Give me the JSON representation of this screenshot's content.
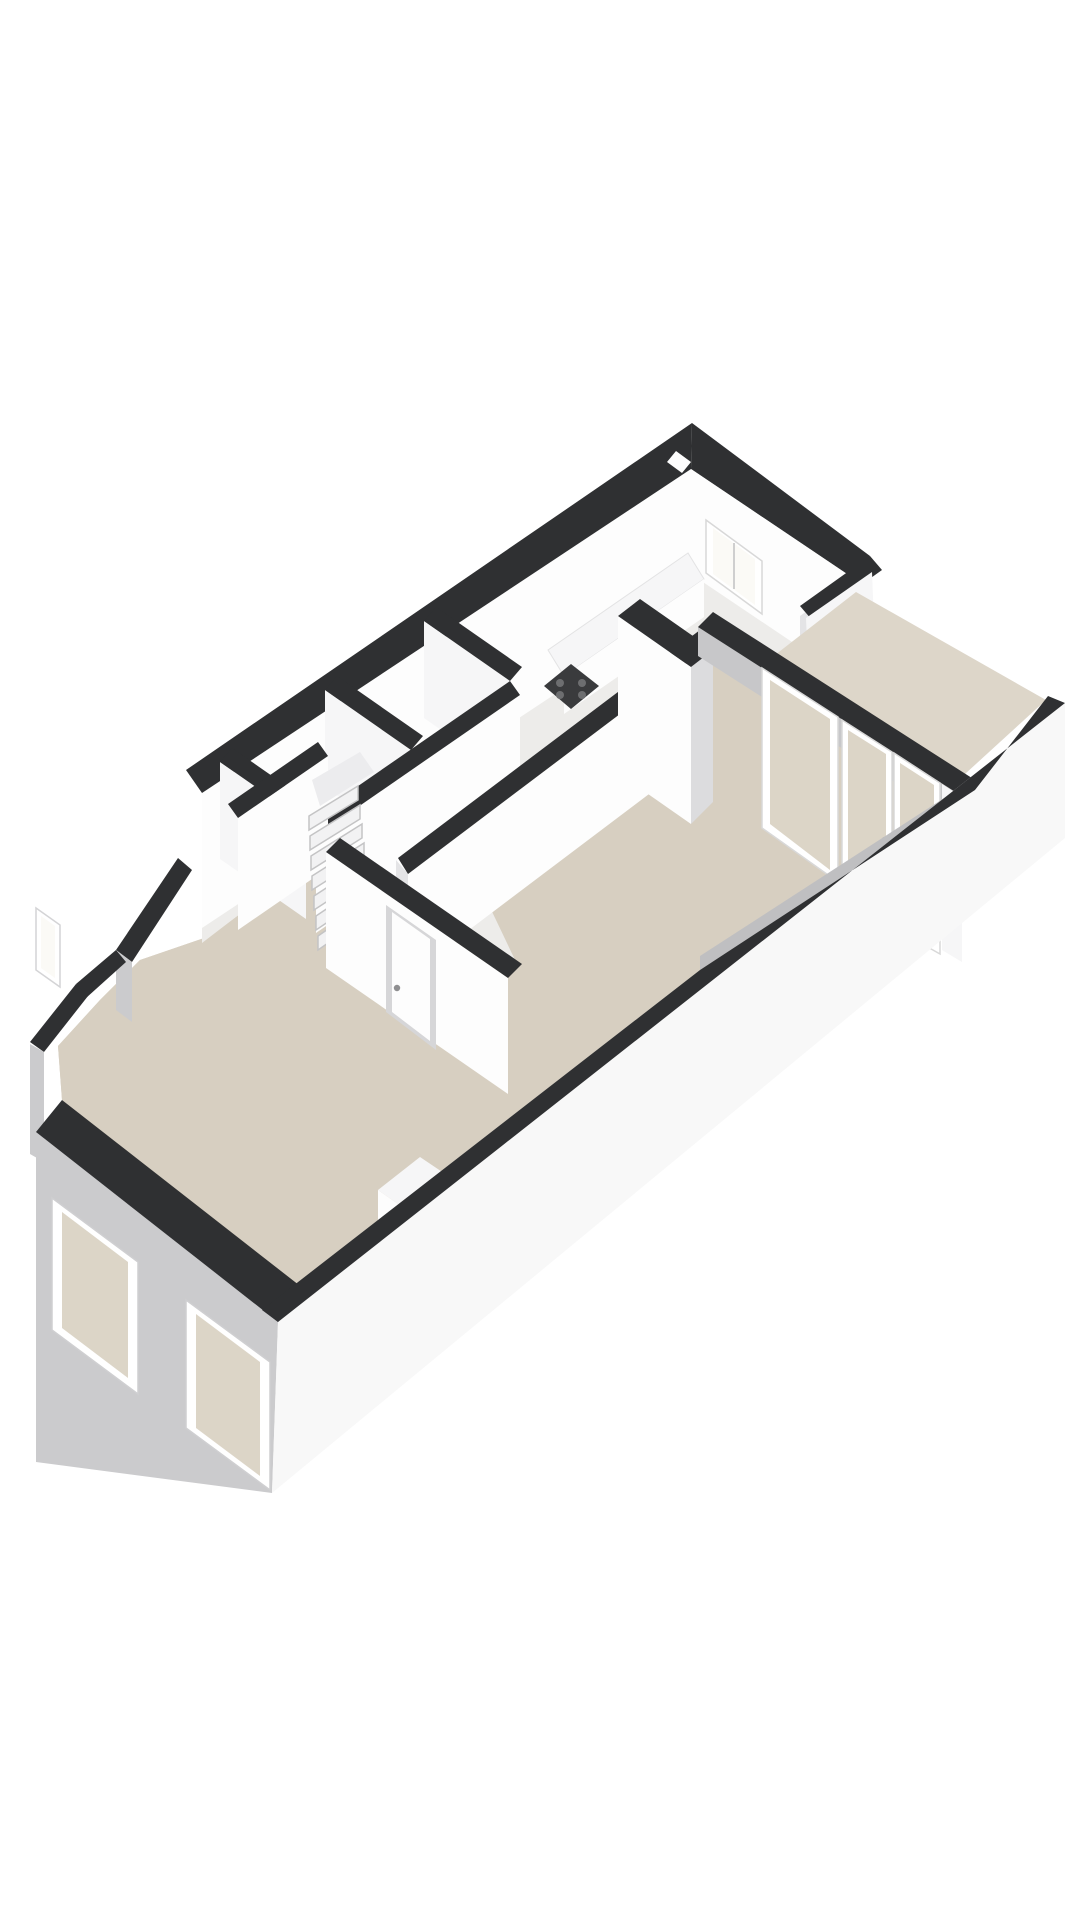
{
  "scene": {
    "type": "isometric-3d-floorplan",
    "background": "#ffffff",
    "palette": {
      "wallTop": "#2f3032",
      "wallWhite": "#fdfdfd",
      "wallFace": "#f6f6f7",
      "wallShade": "#e4e4e6",
      "wallGray": "#d9d9db",
      "extGray": "#cbcbcd",
      "extGrayDark": "#c2c2c4",
      "sidePlane": "#f8f8f8",
      "floorBeige": "#d7cfc1",
      "floorBeigeLight": "#ddd6c9",
      "floorPale": "#edecea",
      "glassBeige": "#dcd5c7",
      "glassWhite": "#fbfaf6",
      "frameWhite": "#ffffff",
      "frameShade": "#d6d6d8",
      "stoveDark": "#3a3b3d",
      "stoveBurner": "#6d6e70",
      "handleGray": "#8f8f91",
      "stepTop": "#f2f2f3",
      "stepEdge": "#c6c6c8",
      "lintelGray": "#c7c7c9",
      "innerStrip": "#bfbfc1",
      "columnSide": "#dcdcde",
      "landing": "#ececee"
    },
    "features": [
      {
        "name": "rear-annex-room",
        "kind": "room"
      },
      {
        "name": "rear-window",
        "kind": "window"
      },
      {
        "name": "kitchen-counter",
        "kind": "fixture"
      },
      {
        "name": "gas-hob",
        "kind": "appliance"
      },
      {
        "name": "chimney-column",
        "kind": "structure"
      },
      {
        "name": "french-doors",
        "kind": "door"
      },
      {
        "name": "garden-window",
        "kind": "window"
      },
      {
        "name": "back-garden-floor",
        "kind": "exterior-floor"
      },
      {
        "name": "right-boundary-wall",
        "kind": "wall"
      },
      {
        "name": "winder-staircase",
        "kind": "stairs"
      },
      {
        "name": "hallway-door",
        "kind": "door"
      },
      {
        "name": "partition-walls",
        "kind": "wall"
      },
      {
        "name": "entrance-diagonal-wall",
        "kind": "wall"
      },
      {
        "name": "front-window-left",
        "kind": "window"
      },
      {
        "name": "front-window-right",
        "kind": "window"
      },
      {
        "name": "left-facade-window",
        "kind": "window"
      },
      {
        "name": "living-room-floor",
        "kind": "floor"
      },
      {
        "name": "furniture-block",
        "kind": "furniture"
      }
    ]
  }
}
